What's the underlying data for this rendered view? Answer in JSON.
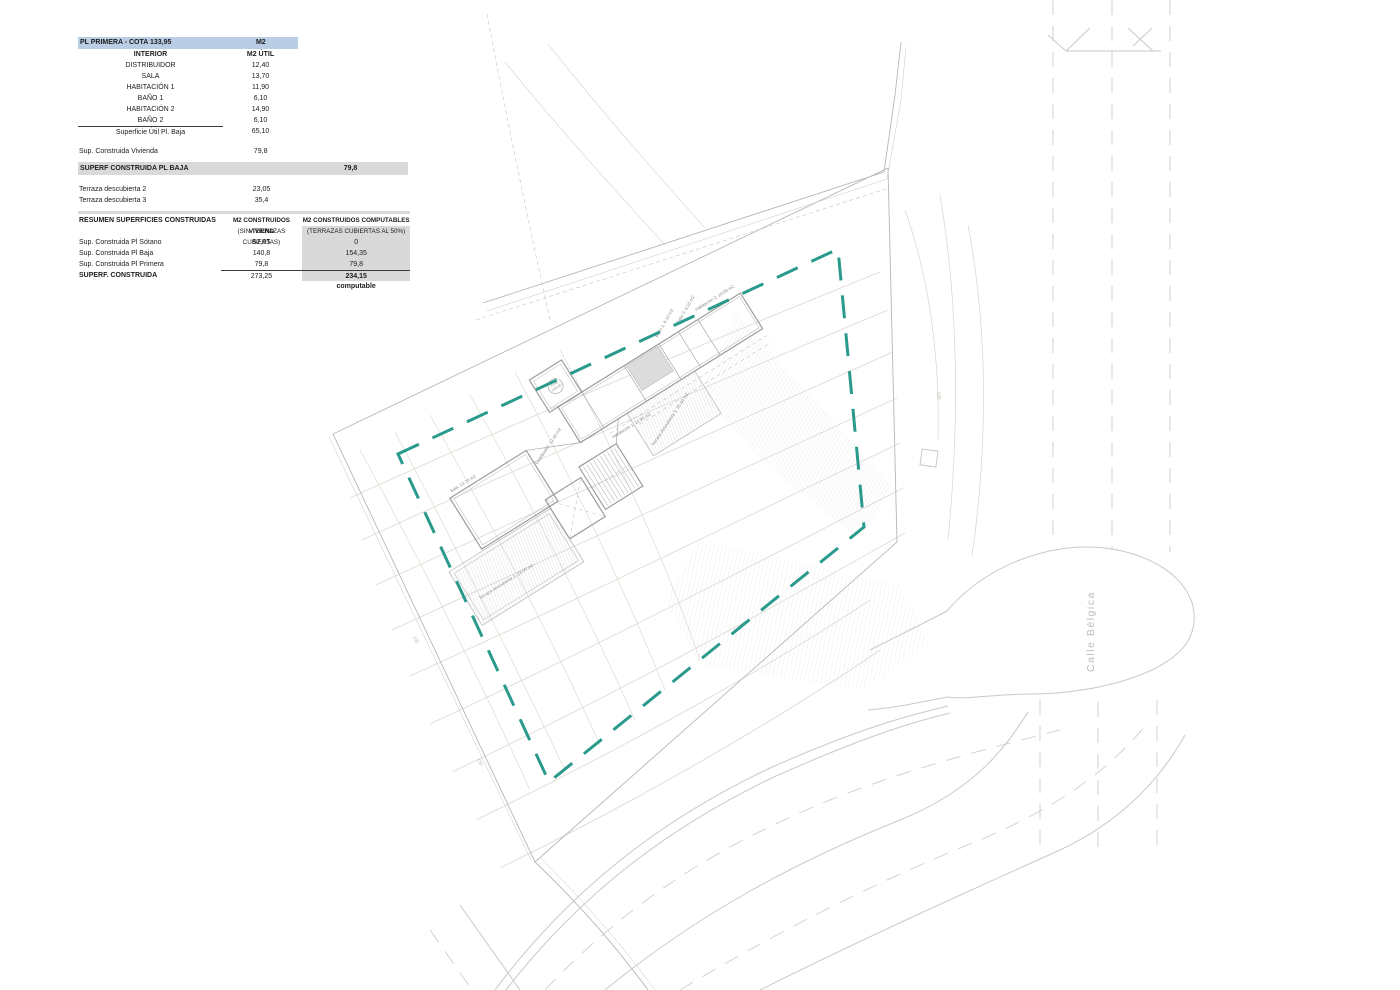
{
  "colors": {
    "teal_boundary": "#2a9a8c",
    "table1_header_bg": "#b9cde4",
    "table_gray_bg": "#d9d9d9",
    "line_gray": "#c9c9c9",
    "contour_gray": "#dcd8cf"
  },
  "tables": {
    "t1": {
      "header": [
        "PL PRIMERA - COTA 133,95",
        "M2"
      ],
      "rows": [
        [
          "INTERIOR",
          "M2 ÚTIL"
        ],
        [
          "DISTRIBUIDOR",
          "12,40"
        ],
        [
          "SALA",
          "13,70"
        ],
        [
          "HABITACIÓN 1",
          "11,90"
        ],
        [
          "BAÑO 1",
          "6,10"
        ],
        [
          "HABITACIÓN 2",
          "14,90"
        ],
        [
          "BAÑO 2",
          "6,10"
        ],
        [
          "Superficie Útil Pl. Baja",
          "65,10"
        ]
      ],
      "footer": [
        "Sup. Construida Vivienda",
        "79,8"
      ]
    },
    "t2": {
      "header": [
        "SUPERF CONSTRUIDA PL BAJA",
        "79,8"
      ],
      "rows": [
        [
          "Terraza descubierta 2",
          "23,05"
        ],
        [
          "Terraza descubierta 3",
          "35,4"
        ]
      ]
    },
    "t3": {
      "header": [
        "RESUMEN SUPERFICIES CONSTRUIDAS",
        "M2 CONSTRUIDOS VIVIEND",
        "M2 CONSTRUIDOS COMPUTABLES"
      ],
      "subheader": [
        "",
        "(SIN TERRAZAS CUBIERTAS)",
        "(TERRAZAS CUBIERTAS AL 50%)"
      ],
      "rows": [
        [
          "Sup. Construida Pl Sótano",
          "52,65",
          "0"
        ],
        [
          "Sup. Construida Pl Baja",
          "140,8",
          "154,35"
        ],
        [
          "Sup. Construida Pl Primera",
          "79,8",
          "79,8"
        ]
      ],
      "total": [
        "SUPERF. CONSTRUIDA",
        "273,25",
        "234,15"
      ],
      "footnote": "computable"
    }
  },
  "plan": {
    "street_label": "Calle Bélgica",
    "cota_line1": "Cota",
    "cota_line2": "133,95",
    "rooms": {
      "habitacion2": "Habitación 2. 14.90 m2",
      "bano2": "Baño 2. 6.10 m2",
      "bano1": "Baño 1. 6.10 m2",
      "habitacion1": "Habitación 1. 11.90 m2",
      "distribuidor": "Distribuidor. 12.40 m2",
      "sala": "Sala. 13.70 m2",
      "terraza3": "Terraza descubierta 3. 35.40 m2",
      "terraza2": "Terraza descubierta 2. 23.05 m2"
    },
    "contour_labels": {
      "l135": "135",
      "l130a": "130",
      "l130b": "130"
    }
  }
}
